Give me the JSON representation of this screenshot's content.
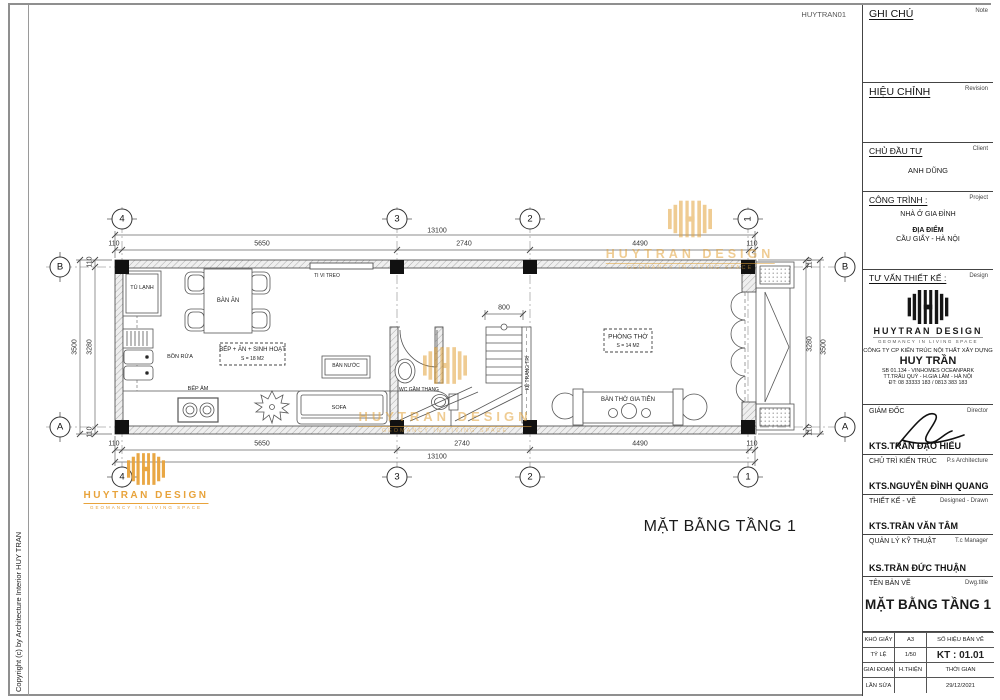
{
  "sheet": {
    "code": "HUYTRAN01",
    "copyright": "Copyright (c) by  Architecture Interior HUY TRAN",
    "plan_title": "MẶT BẰNG TẦNG 1"
  },
  "brand": {
    "name": "HUYTRAN DESIGN",
    "tagline": "GEOMANCY IN LIVING SPACE",
    "gold": "#E2A33B"
  },
  "title_block": {
    "note": {
      "vi": "GHI CHÚ",
      "en": "Note"
    },
    "revision": {
      "vi": "HIỆU CHỈNH",
      "en": "Revision"
    },
    "client": {
      "vi": "CHỦ ĐẦU TƯ",
      "en": "Client",
      "value": "ANH DŨNG"
    },
    "project": {
      "vi": "CÔNG TRÌNH :",
      "en": "Project",
      "value": "NHÀ Ở GIA ĐÌNH",
      "location_label": "ĐỊA ĐIỂM",
      "location": "CẦU GIẤY - HÀ NỘI"
    },
    "design": {
      "vi": "TƯ VẤN THIẾT KẾ :",
      "en": "Design",
      "company": "CÔNG TY CP KIẾN TRÚC NỘI THẤT XÂY DỰNG",
      "name": "HUY TRẦN",
      "address1": "SB 01.134 - VINHOMES OCEANPARK",
      "address2": "TT.TRÂU QUỲ - H.GIA LÂM - HÀ NỘI",
      "phone": "ĐT: 08 33333 183 / 0813 383 183"
    },
    "staff": [
      {
        "vi": "GIÁM ĐỐC",
        "en": "Director",
        "name": "KTS.TRẦN ĐẠO HIẾU"
      },
      {
        "vi": "CHỦ TRÌ KIẾN TRÚC",
        "en": "P.s Architecture",
        "name": "KTS.NGUYỄN ĐÌNH QUANG"
      },
      {
        "vi": "THIẾT KẾ - VẼ",
        "en": "Designed - Drawn",
        "name": "KTS.TRẦN VĂN TÂM"
      },
      {
        "vi": "QUẢN LÝ KỸ THUẬT",
        "en": "T.c Manager",
        "name": "KS.TRẦN ĐỨC THUẬN"
      }
    ],
    "drawing": {
      "vi": "TÊN BẢN VẼ",
      "en": "Dwg.title",
      "title": "MẶT BẰNG TẦNG 1"
    },
    "info": {
      "paper_label": "KHỔ GIẤY",
      "paper": "A3",
      "number_label": "SỐ HIỆU BẢN VẼ",
      "scale_label": "TỶ LỆ",
      "scale": "1/50",
      "number": "KT : 01.01",
      "phase_label": "GIAI ĐOẠN",
      "phase": "H.THIỆN",
      "time_label": "THỜI GIAN",
      "revision_label": "LẦN SỬA",
      "date": "29/12/2021"
    }
  },
  "plan": {
    "grid_cols": [
      "4",
      "3",
      "2",
      "1"
    ],
    "grid_rows": [
      "B",
      "A"
    ],
    "dims": {
      "total": "13100",
      "segs": [
        "110",
        "5650",
        "2740",
        "4490",
        "110"
      ],
      "left": {
        "total": "3500",
        "inner": "3280",
        "t": "110",
        "b": "110"
      },
      "right": {
        "total": "3500",
        "inner": "3280",
        "t": "110",
        "b": "110"
      },
      "stair": "800"
    },
    "rooms": {
      "kitchen": {
        "name": "BẾP + ĂN + SINH HOẠT",
        "area": "S = 18 M2"
      },
      "worship": {
        "name": "PHÒNG THỜ",
        "area": "S = 14 M2"
      }
    },
    "labels": {
      "fridge": "TỦ LẠNH",
      "dining": "BÀN ĂN",
      "sink": "BỒN RỬA",
      "stove": "BẾP ÂM",
      "tv": "TI VI TREO",
      "tea_table": "BÀN NƯỚC",
      "sofa": "SOFA",
      "wc": "WC GẦM THANG",
      "shelf": "KỆ TRANG TRÍ",
      "altar": "BÀN THỜ GIA TIÊN"
    }
  }
}
